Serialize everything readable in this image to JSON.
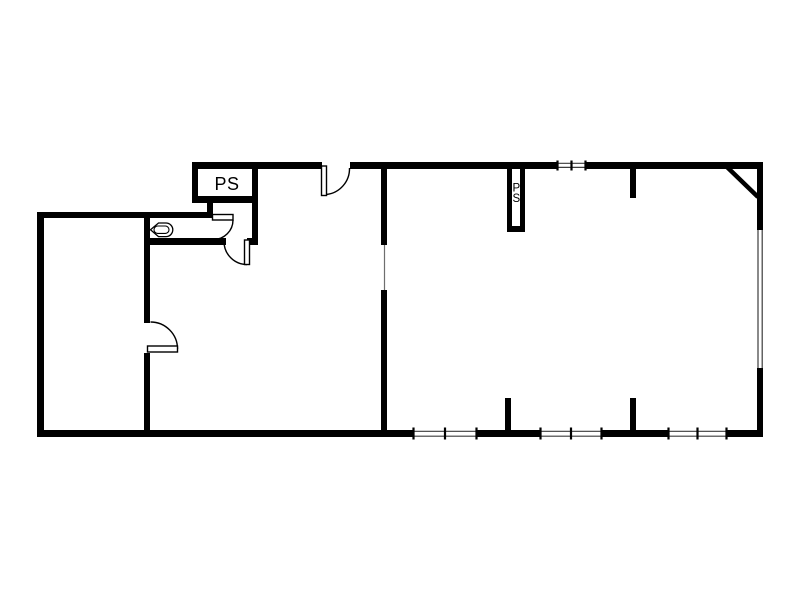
{
  "page": {
    "background": "#ffffff"
  },
  "plan": {
    "type": "architectural-floor-plan",
    "colors": {
      "wall": "#000000",
      "window_line": "#3c3c3c",
      "opening_line": "#6e6e6e",
      "label": "#000000",
      "interior_fill": "#ffffff"
    },
    "labels": {
      "pipe_shaft_left": "PS",
      "pipe_shaft_right": [
        "P",
        "S"
      ]
    },
    "symbols": {
      "doors": [
        "top-entry-door",
        "wc-door",
        "toilet-entry-door",
        "left-room-door"
      ],
      "windows": [
        "top-window",
        "right-window",
        "bottom-window-1",
        "bottom-window-2",
        "bottom-window-3"
      ],
      "fixtures": [
        "urinal"
      ],
      "shafts": [
        "pipe-shaft-left",
        "pipe-shaft-right"
      ]
    }
  }
}
